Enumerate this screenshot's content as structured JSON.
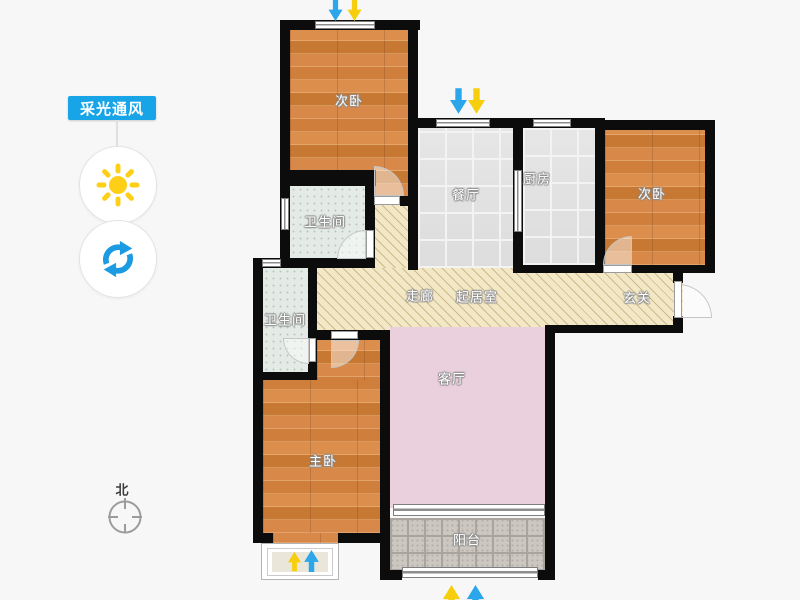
{
  "panel": {
    "label": "采光通风"
  },
  "compass": {
    "north_label": "北"
  },
  "rooms": {
    "bedroom_top": "次卧",
    "dining": "餐厅",
    "kitchen": "厨房",
    "bedroom_right": "次卧",
    "bath_upper": "卫生间",
    "bath_lower": "卫生间",
    "corridor": "走廊",
    "living_core": "起居室",
    "foyer": "玄关",
    "living": "客厅",
    "master": "主卧",
    "balcony": "阳台"
  },
  "icons": {
    "sun-icon": "sun glyph (daylight mode)",
    "rotate-icon": "circular arrows (rotate plan)",
    "north-compass-icon": "compass circle with crosshair",
    "wind-down-arrow-icon": "blue arrow down",
    "light-down-arrow-icon": "yellow arrow down",
    "wind-up-arrow-icon": "blue arrow up",
    "light-up-arrow-icon": "yellow arrow up"
  },
  "colors": {
    "tag_blue": "#18a5e8",
    "sun_yellow": "#fdd017",
    "rotate_blue": "#1c9be2",
    "arrow_blue": "#2ba6ea",
    "arrow_yellow": "#f6ce0d",
    "wall_black": "#0c0c0c",
    "wood_floor": "#d0803d",
    "living_pink": "#eacfdc",
    "hatch_beige": "#f3e8c6",
    "tile_gray": "#e2e2e2",
    "bath_tile": "#e4ebe6",
    "balcony_gray": "#ccc8c1"
  }
}
